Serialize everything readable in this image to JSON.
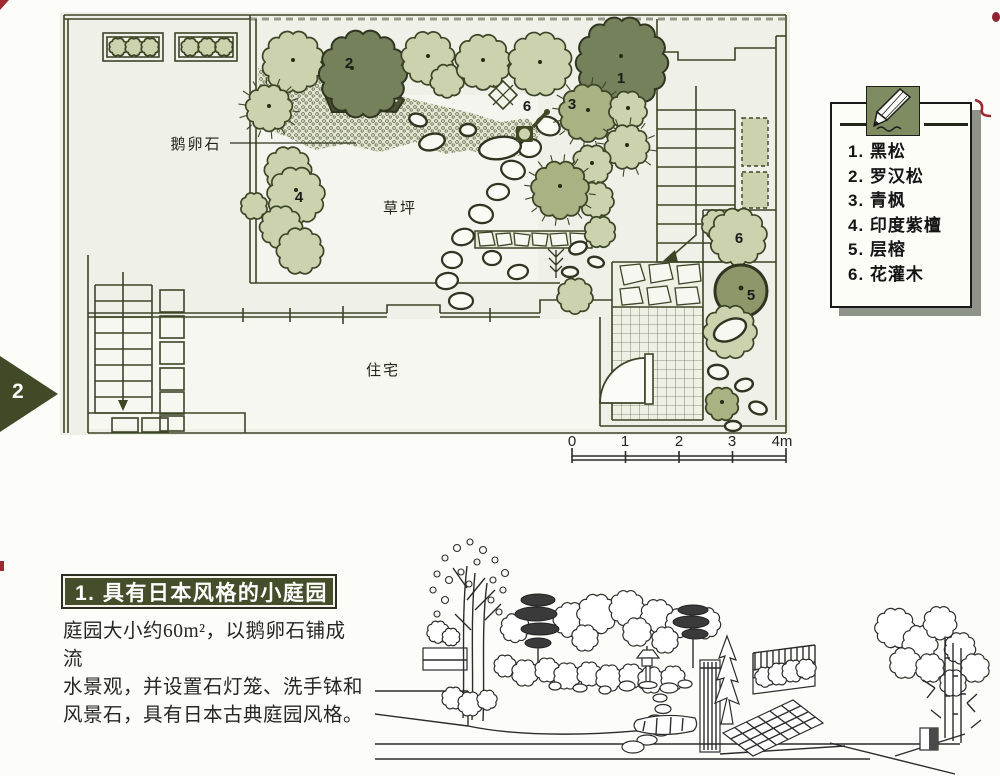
{
  "page": {
    "side_marker": "2"
  },
  "plan": {
    "labels": {
      "cobblestone": "鹅卵石",
      "lawn": "草坪",
      "house": "住宅"
    },
    "markers": {
      "n1": "1",
      "n2": "2",
      "n3": "3",
      "n4": "4",
      "n5": "5",
      "n6_top": "6",
      "n6_right": "6"
    },
    "scale": {
      "t0": "0",
      "t1": "1",
      "t2": "2",
      "t3": "3",
      "t4": "4m"
    }
  },
  "legend": {
    "items": [
      "1. 黑松",
      "2. 罗汉松",
      "3. 青枫",
      "4. 印度紫檀",
      "5. 层榕",
      "6. 花灌木"
    ]
  },
  "section": {
    "title": "1. 具有日本风格的小庭园",
    "desc": [
      "庭园大小约60m²，以鹅卵石铺成流",
      "水景观，并设置石灯笼、洗手钵和",
      "风景石，具有日本古典庭园风格。"
    ]
  },
  "colors": {
    "banner_bg": "#454d2a",
    "marker_bg": "#414a26",
    "tree_light": "#cbd2ad",
    "tree_mid": "#a8b283",
    "tree_dark": "#75815a",
    "pencil_bg": "#7f8c62",
    "red_mark": "#9c2a33",
    "plan_line": "#3d4527"
  }
}
